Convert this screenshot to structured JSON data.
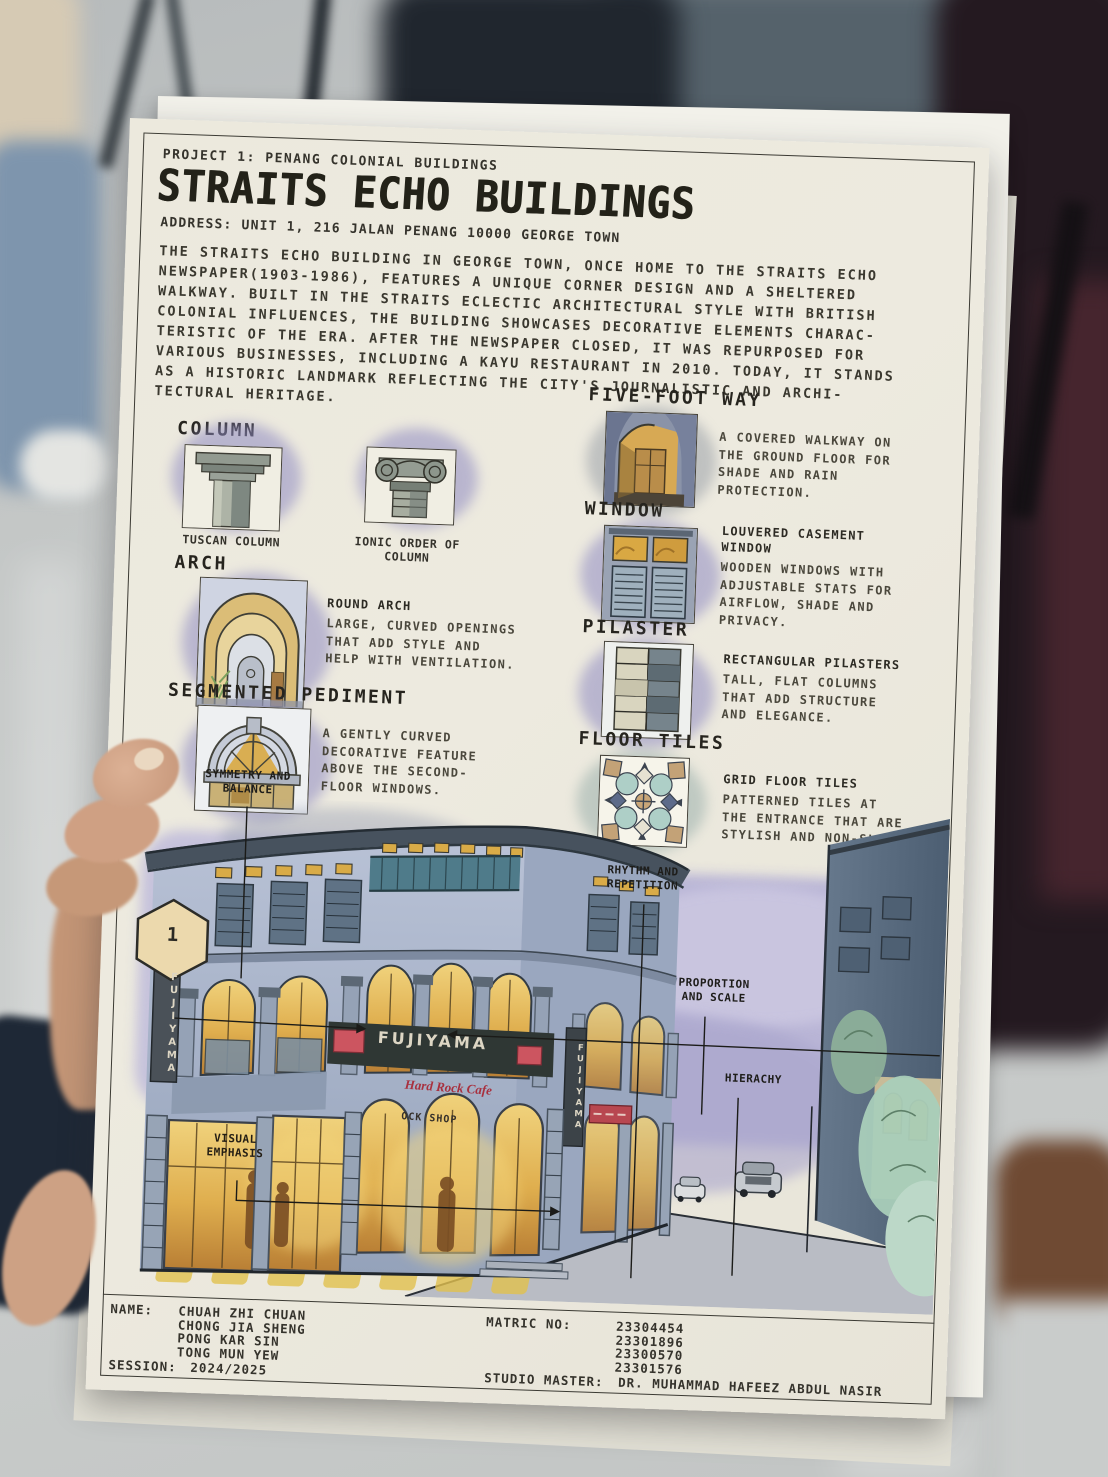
{
  "page": {
    "project_line": "PROJECT 1: PENANG COLONIAL BUILDINGS",
    "title": "STRAITS ECHO BUILDINGS",
    "address": "ADDRESS: UNIT 1, 216 JALAN PENANG 10000 GEORGE TOWN",
    "description": "THE STRAITS ECHO BUILDING IN GEORGE TOWN, ONCE HOME TO THE STRAITS ECHO\nNEWSPAPER(1903-1986), FEATURES A UNIQUE CORNER DESIGN AND A SHELTERED\nWALKWAY. BUILT IN THE STRAITS ECLECTIC ARCHITECTURAL STYLE WITH BRITISH\nCOLONIAL INFLUENCES, THE BUILDING SHOWCASES DECORATIVE ELEMENTS CHARAC-\nTERISTIC OF THE ERA. AFTER THE NEWSPAPER CLOSED, IT WAS REPURPOSED FOR\nVARIOUS BUSINESSES, INCLUDING A KAYU RESTAURANT IN 2010. TODAY, IT STANDS\nAS A HISTORIC LANDMARK REFLECTING THE CITY'S JOURNALISTIC AND ARCHI-\nTECTURAL HERITAGE."
  },
  "features": {
    "column": {
      "heading": "COLUMN",
      "caption_left": "TUSCAN COLUMN",
      "caption_right": "IONIC ORDER OF\nCOLUMN"
    },
    "five_foot_way": {
      "heading": "FIVE-FOOT WAY",
      "body": "A COVERED WALKWAY ON\nTHE GROUND FLOOR FOR\nSHADE AND RAIN\nPROTECTION."
    },
    "arch": {
      "heading": "ARCH",
      "subheading": "ROUND ARCH",
      "body": "LARGE, CURVED OPENINGS\nTHAT ADD STYLE AND\nHELP WITH VENTILATION."
    },
    "window": {
      "heading": "WINDOW",
      "subheading": "LOUVERED CASEMENT\nWINDOW",
      "body": "WOODEN WINDOWS WITH\nADJUSTABLE STATS FOR\nAIRFLOW, SHADE AND\nPRIVACY."
    },
    "segmented_pediment": {
      "heading": "SEGMENTED PEDIMENT",
      "body": "A GENTLY CURVED\nDECORATIVE FEATURE\nABOVE THE SECOND-\nFLOOR WINDOWS."
    },
    "pilaster": {
      "heading": "PILASTER",
      "subheading": "RECTANGULAR PILASTERS",
      "body": "TALL, FLAT COLUMNS\nTHAT ADD STRUCTURE\nAND ELEGANCE."
    },
    "floor_tiles": {
      "heading": "FLOOR TILES",
      "subheading": "GRID FLOOR TILES",
      "body": "PATTERNED TILES AT\nTHE ENTRANCE THAT ARE\nSTYLISH AND NON-SLIP"
    }
  },
  "drawing": {
    "labels": {
      "symmetry": "SYMMETRY AND\nBALANCE",
      "rhythm": "RHYTHM AND\nREPETITION",
      "proportion": "PROPORTION\nAND SCALE",
      "hierarchy": "HIERACHY",
      "visual_emphasis": "VISUAL\nEMPHASIS",
      "marker_number": "1"
    },
    "signs": {
      "fujiyama_main": "FUJIYAMA",
      "fujiyama_vertical_left": "FUJIYAMA",
      "fujiyama_vertical_right": "FUJIYAMA",
      "hard_rock_cafe": "Hard Rock Cafe",
      "rock_shop": "OCK SHOP"
    }
  },
  "footer": {
    "name_label": "NAME:",
    "names": "CHUAH ZHI CHUAN\nCHONG JIA SHENG\nPONG KAR SIN\nTONG MUN YEW",
    "matric_label": "MATRIC NO:",
    "matric_numbers": "23304454\n23301896\n23300570\n23301576",
    "session_label": "SESSION:",
    "session_value": "2024/2025",
    "studio_label": "STUDIO MASTER:",
    "studio_value": "DR. MUHAMMAD HAFEEZ ABDUL NASIR"
  },
  "colors": {
    "paper": "#ece9dd",
    "ink": "#35332c",
    "sky_wash": "#beb9d9",
    "facade": "#a6b1c7",
    "window_glow": "#d9a843",
    "sign_red": "#cc5560",
    "balcony_teal": "#4f7b8a"
  }
}
